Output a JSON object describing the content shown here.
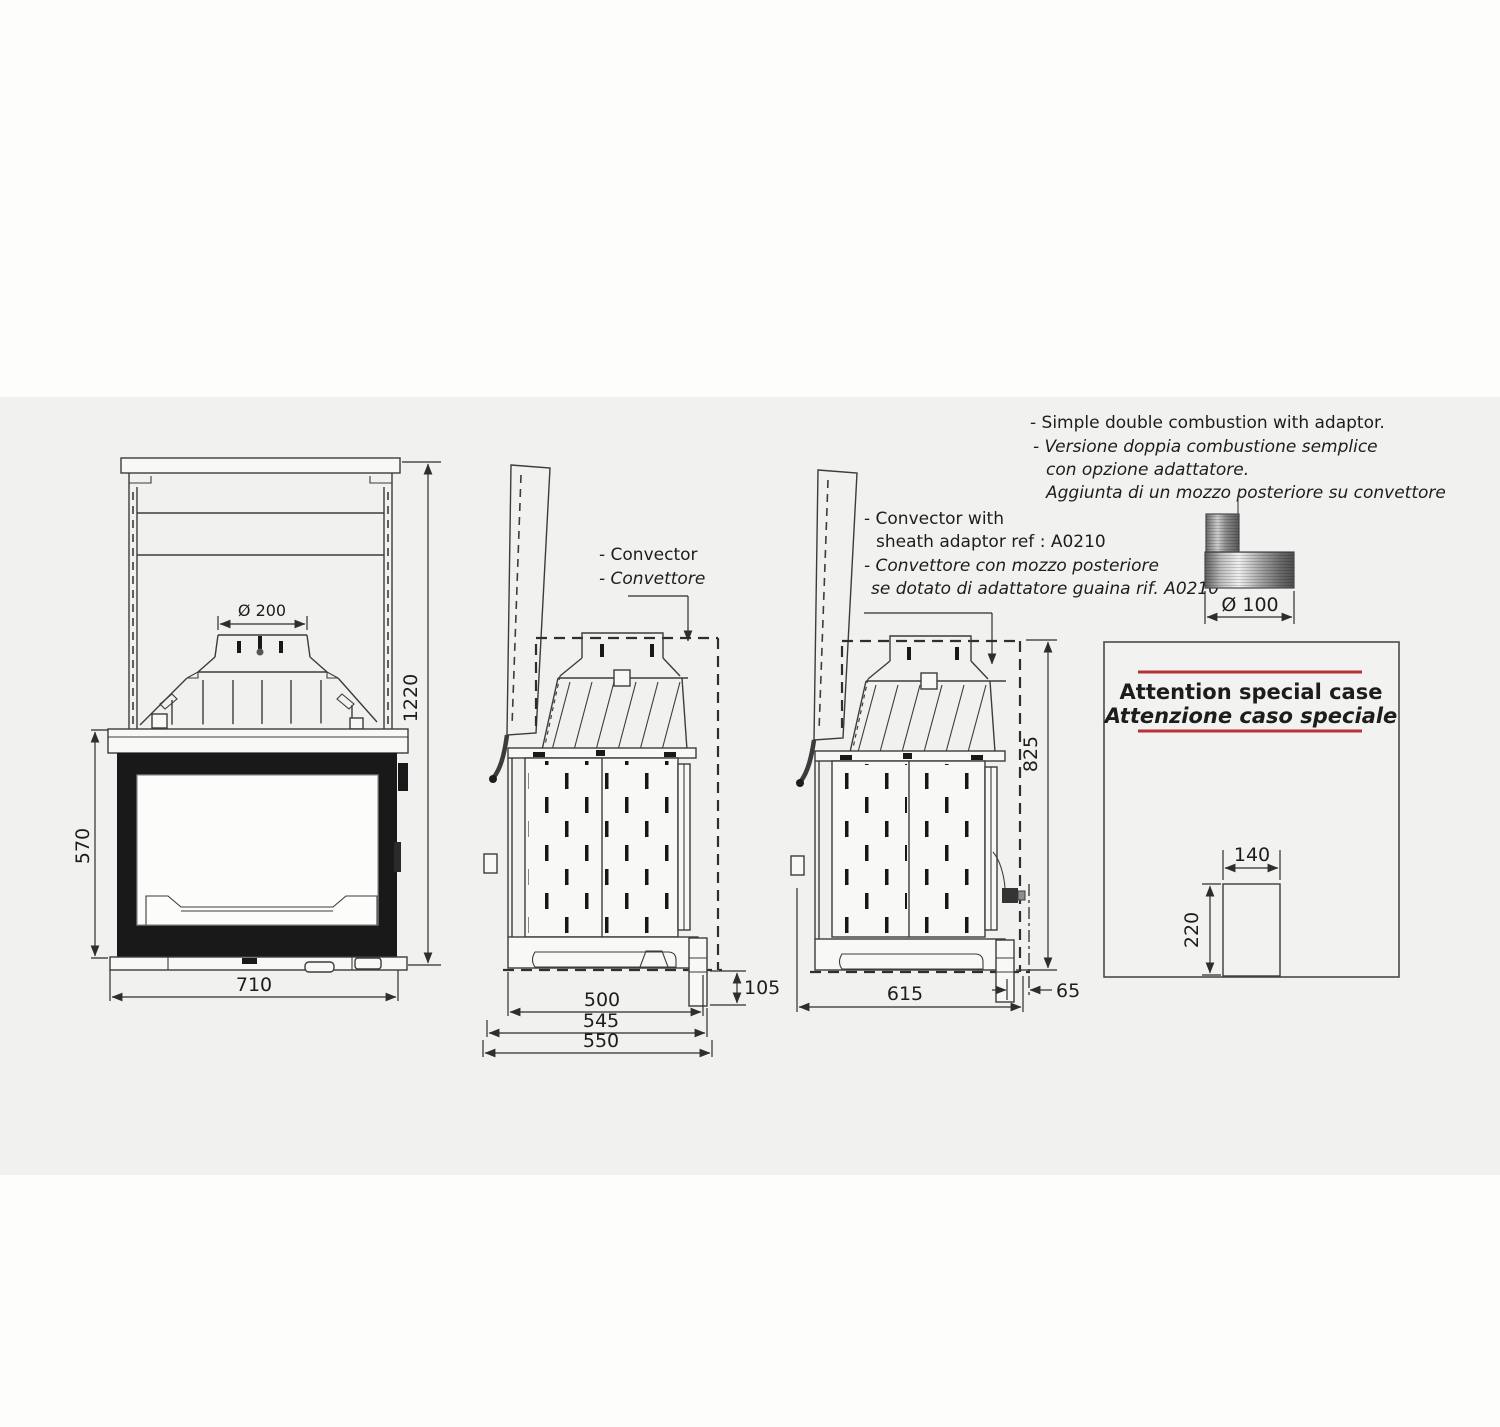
{
  "colors": {
    "panel_bg": "#f1f1ef",
    "line": "#3c3c3c",
    "accent_red": "#b63434"
  },
  "notes": {
    "line1": "- Simple double combustion with adaptor.",
    "line2": "- Versione doppia combustione semplice",
    "line3": "con opzione adattatore.",
    "line4": "Aggiunta di un mozzo posteriore su convettore"
  },
  "front_view": {
    "flue_diameter": "Ø 200",
    "firebox_height": "570",
    "width": "710",
    "total_height": "1220"
  },
  "side_view": {
    "label_en": "- Convector",
    "label_it": "- Convettore",
    "hearth_drop": "105",
    "depth_body": "500",
    "depth_mid": "545",
    "depth_total": "550"
  },
  "adaptor_view": {
    "label_line1": "- Convector with",
    "label_line2": "sheath adaptor ref : A0210",
    "label_line3": "- Convettore  con mozzo posteriore",
    "label_line4": "se dotato di adattatore guaina  rif. A0210",
    "height": "825",
    "depth": "615",
    "offset": "65"
  },
  "sheath_adapter": {
    "diameter": "Ø 100"
  },
  "attention": {
    "title_en": "Attention special case",
    "title_it": "Attenzione caso speciale",
    "width": "140",
    "height": "220"
  }
}
